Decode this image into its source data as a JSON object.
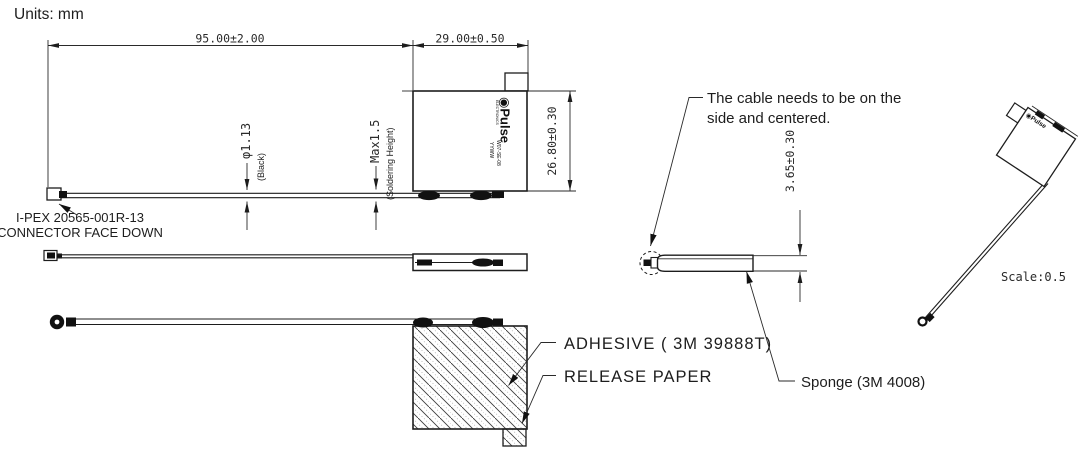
{
  "colors": {
    "ink": "#1d1d1d",
    "background": "#ffffff"
  },
  "header": {
    "units": "Units: mm"
  },
  "front_view": {
    "dim_cable_length": "95.00±2.00",
    "dim_body_width": "29.00±0.50",
    "dim_body_height": "26.80±0.30",
    "dim_cable_diameter": "φ1.13",
    "dim_cable_diameter_note": "(Black)",
    "dim_solder": "Max1.5",
    "dim_solder_note": "(Soldering Height)",
    "connector_note_line1": "I-PEX 20565-001R-13",
    "connector_note_line2": "CONNECTOR FACE DOWN",
    "brand": {
      "mark": "◉",
      "name": "Pulse",
      "sub": "ELECTRONICS",
      "code1": "W07-SE-08",
      "code2": "YYWW"
    }
  },
  "bottom_view": {
    "adhesive_label": "ADHESIVE ( 3M 39888T)",
    "release_paper_label": "RELEASE PAPER"
  },
  "side_view": {
    "note_line1": "The cable needs to be on the",
    "note_line2": "side and centered.",
    "dim_thickness": "3.65±0.30",
    "sponge_label": "Sponge (3M 4008)"
  },
  "iso_view": {
    "scale_label": "Scale:0.5",
    "brand_mark": "◉",
    "brand_name": "Pulse"
  }
}
